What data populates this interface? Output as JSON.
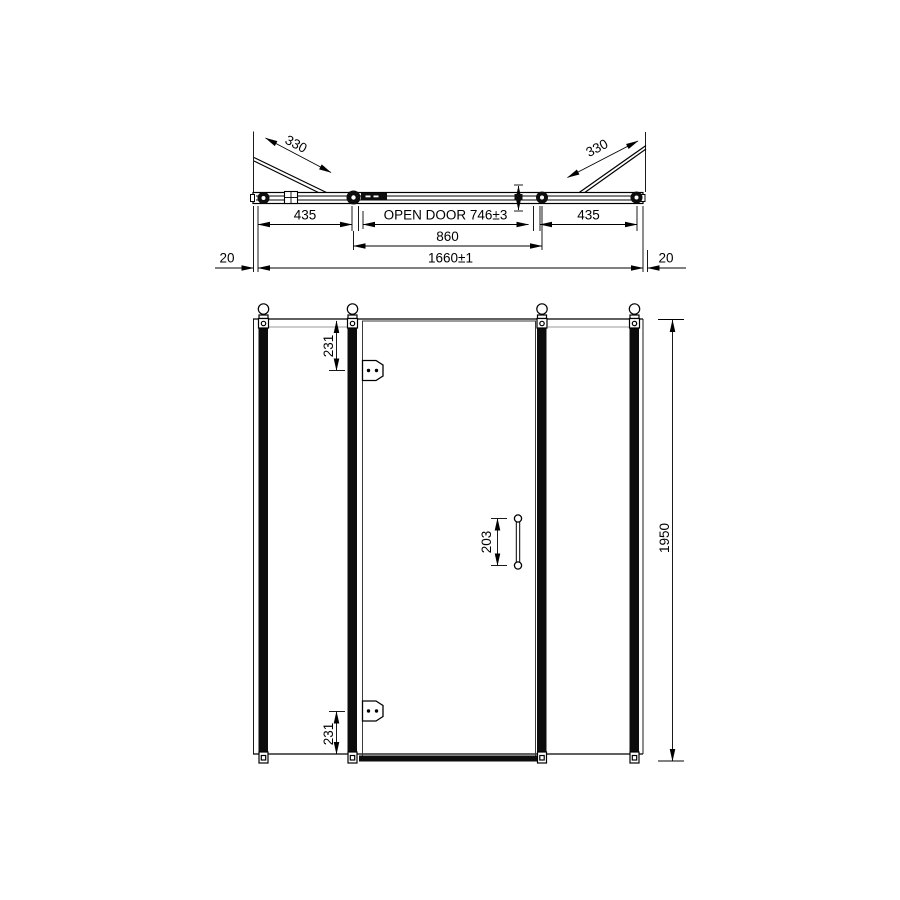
{
  "plan": {
    "dim_330_left": "330",
    "dim_330_right": "330",
    "dim_435_left": "435",
    "dim_open_door": "OPEN DOOR 746±3",
    "dim_435_right": "435",
    "dim_860": "860",
    "dim_20_left": "20",
    "dim_1660": "1660±1",
    "dim_20_right": "20"
  },
  "elevation": {
    "dim_231_top": "231",
    "dim_203_handle": "203",
    "dim_231_bottom": "231",
    "dim_1950": "1950"
  },
  "colors": {
    "line": "#000000",
    "secondary_line": "#999999",
    "background": "#ffffff"
  }
}
